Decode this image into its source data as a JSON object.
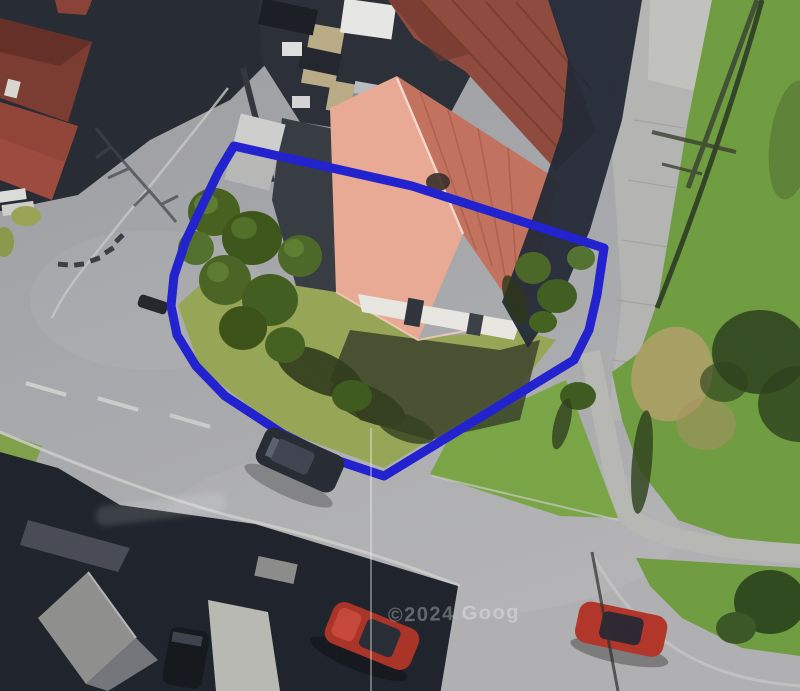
{
  "map": {
    "type": "aerial-satellite-view",
    "description": "Aerial photograph of a detached property with red hipped roof, garden trees and surrounding roads; plot outlined in blue",
    "imagery_watermark": "©2024 Goog",
    "boundary": {
      "color": "#2020cf",
      "stroke_width": 9,
      "points": [
        [
          234,
          146
        ],
        [
          412,
          186
        ],
        [
          604,
          248
        ],
        [
          597,
          295
        ],
        [
          589,
          330
        ],
        [
          574,
          360
        ],
        [
          384,
          476
        ],
        [
          333,
          459
        ],
        [
          283,
          434
        ],
        [
          225,
          396
        ],
        [
          196,
          366
        ],
        [
          177,
          335
        ],
        [
          171,
          306
        ],
        [
          174,
          276
        ],
        [
          186,
          240
        ],
        [
          204,
          202
        ],
        [
          219,
          171
        ]
      ]
    },
    "colors": {
      "road": "#a6a7aa",
      "grass_field": "#6f9c40",
      "grass_triangle": "#79a546",
      "lawn": "#97a556",
      "roof_light_face": "#e9aa95",
      "roof_dark_face": "#c3725e",
      "roof_north_wing": "#8e4a3d",
      "house_roof_left_a": "#7a3a30",
      "house_roof_left_b": "#9c4a3c"
    },
    "cars": [
      {
        "name": "dark-car-on-road",
        "color": "#262b33"
      },
      {
        "name": "red-car-center",
        "color": "#a93226"
      },
      {
        "name": "red-car-right",
        "color": "#b23529"
      },
      {
        "name": "dark-car-driveway",
        "color": "#14171c"
      }
    ]
  }
}
